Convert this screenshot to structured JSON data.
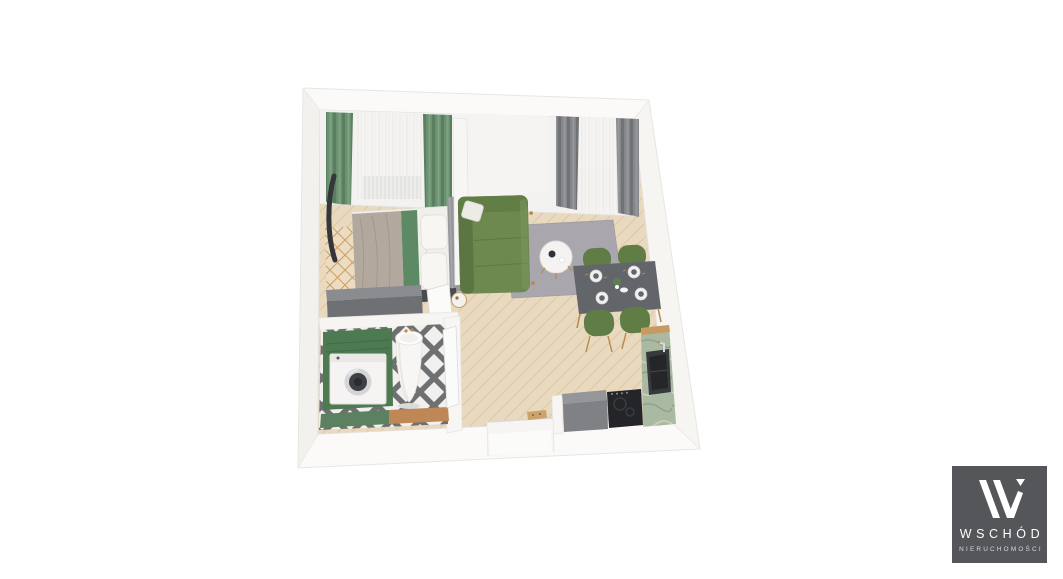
{
  "page": {
    "background_color": "#ffffff"
  },
  "logo": {
    "brand": "WSCHÓD",
    "subtitle": "NIERUCHOMOŚCI",
    "background_color": "#54565a",
    "mark_color": "#ffffff",
    "brand_text_color": "#ffffff",
    "subtitle_text_color": "#d8d9da"
  },
  "palette": {
    "wall_white": "#f7f6f3",
    "wall_bright": "#fbfaf8",
    "wood_floor_tan": "#e9d9be",
    "green_curtain": "#6b9170",
    "gray_curtain": "#85878b",
    "sofa_green": "#6d8950",
    "rug_gray": "#a9a7ad",
    "dining_table_gray": "#62666b",
    "chair_green": "#5f7d45",
    "kitchen_counter_sage": "#aab9a1",
    "cooktop_black": "#232528",
    "cabinet_gray": "#7f8185",
    "bath_cabinet_green": "#4e7a52",
    "bath_tile_dark": "#6e7072",
    "bed_blanket_taupe": "#b3a89d",
    "bed_accent_green": "#5d8a64",
    "headboard_gray": "#96989c",
    "dresser_gray": "#6e7074",
    "gold_wood_accent": "#bb8d52"
  }
}
